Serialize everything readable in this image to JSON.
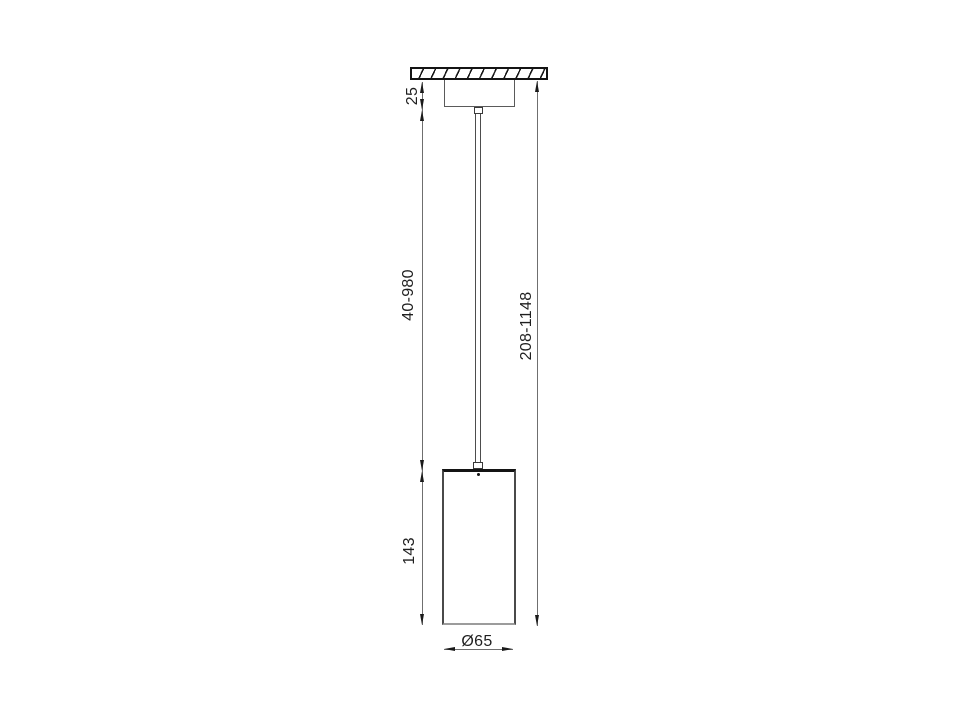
{
  "drawing": {
    "title": "pendant-lamp-dimension-drawing",
    "dimensions": {
      "canopy_height": "25",
      "suspension_length": "40-980",
      "total_length": "208-1148",
      "shade_height": "143",
      "shade_diameter": "Ø65"
    },
    "colors": {
      "background": "#ffffff",
      "object_line": "#141414",
      "dimension_line": "#6f6f6f",
      "label_text": "#1f1f1f"
    }
  }
}
